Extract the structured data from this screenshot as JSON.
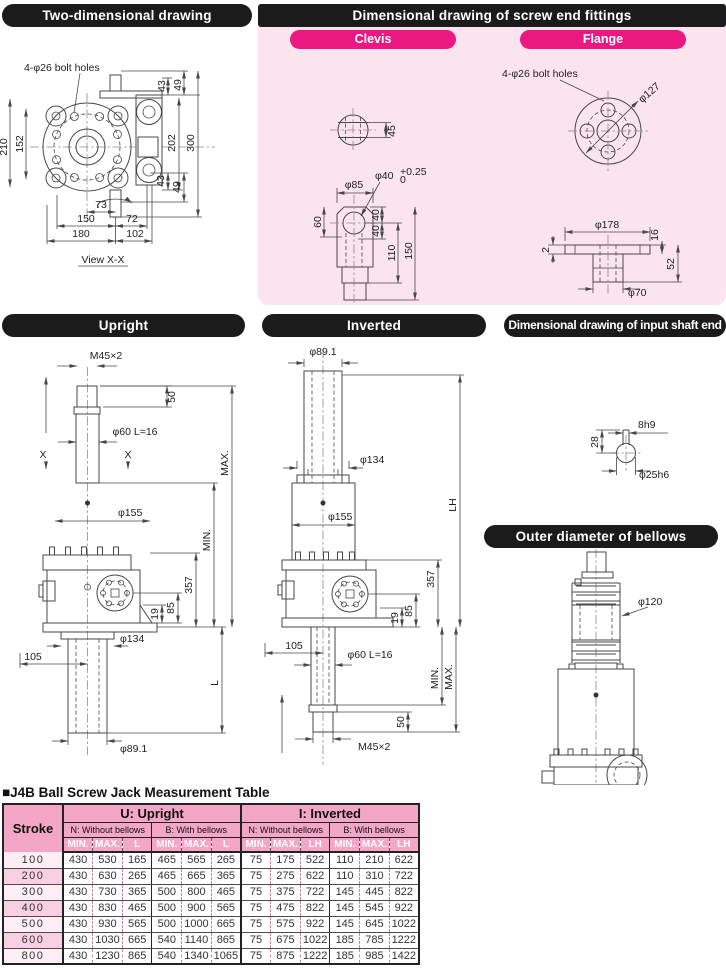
{
  "colors": {
    "header_bar": "#1b1b1b",
    "panel_pink": "#fce4ef",
    "accent_magenta": "#ec1882",
    "table_header_pink": "#f3a6c5",
    "row_stripe_pink": "#fde6f1",
    "line_color": "#474747"
  },
  "headers": {
    "two_dimensional": "Two-dimensional drawing",
    "screw_end": "Dimensional drawing of screw end fittings",
    "clevis": "Clevis",
    "flange": "Flange",
    "upright": "Upright",
    "inverted": "Inverted",
    "input_shaft": "Dimensional drawing of input shaft end",
    "bellows": "Outer diameter of bellows"
  },
  "two_dim": {
    "bolt_holes": "4-φ26 bolt holes",
    "d210": "210",
    "d152": "152",
    "d43_top": "43",
    "d49_top": "49",
    "d202": "202",
    "d300": "300",
    "d43_bot": "43",
    "d49_bot": "49",
    "d73": "73",
    "d150": "150",
    "d72": "72",
    "d180": "180",
    "d102": "102",
    "view_label": "View X-X"
  },
  "clevis_drawing": {
    "d45": "45",
    "d85": "φ85",
    "d40": "φ40",
    "d40_tol_top": "+0.25",
    "d40_tol_bot": "0",
    "d60": "60",
    "d40a": "40",
    "d40b": "40",
    "d110": "110",
    "d150": "150"
  },
  "flange_drawing": {
    "bolt_holes": "4-φ26 bolt holes",
    "d127": "φ127",
    "d178": "φ178",
    "d2": "2",
    "d16": "16",
    "d52": "52",
    "d70": "φ70"
  },
  "upright_drawing": {
    "m45": "M45×2",
    "d50": "50",
    "d60": "φ60 L=16",
    "x_left": "X",
    "x_right": "X",
    "max": "MAX.",
    "min": "MIN.",
    "d155": "φ155",
    "d357": "357",
    "d19": "19",
    "d85": "85",
    "d134": "φ134",
    "d105": "105",
    "L": "L",
    "d891": "φ89.1"
  },
  "inverted_drawing": {
    "d891": "φ89.1",
    "d134": "φ134",
    "lh": "LH",
    "d155": "φ155",
    "d357": "357",
    "d19": "19",
    "d85": "85",
    "d105": "105",
    "d60": "φ60 L=16",
    "min": "MIN.",
    "max": "MAX.",
    "d50": "50",
    "m45": "M45×2"
  },
  "input_shaft_drawing": {
    "d28": "28",
    "key": "8h9",
    "shaft": "φ25h6"
  },
  "bellows_drawing": {
    "d120": "φ120"
  },
  "table": {
    "title": "■J4B Ball Screw Jack Measurement Table",
    "stroke_header": "Stroke",
    "groups": [
      {
        "label": "U: Upright",
        "subs": [
          {
            "label": "N: Without bellows",
            "cols": [
              "MIN.",
              "MAX.",
              "L"
            ]
          },
          {
            "label": "B: With bellows",
            "cols": [
              "MIN.",
              "MAX.",
              "L"
            ]
          }
        ]
      },
      {
        "label": "I: Inverted",
        "subs": [
          {
            "label": "N: Without bellows",
            "cols": [
              "MIN.",
              "MAX.",
              "LH"
            ]
          },
          {
            "label": "B: With bellows",
            "cols": [
              "MIN.",
              "MAX.",
              "LH"
            ]
          }
        ]
      }
    ],
    "rows": [
      {
        "stroke": "100",
        "values": [
          "430",
          "530",
          "165",
          "465",
          "565",
          "265",
          "75",
          "175",
          "522",
          "110",
          "210",
          "622"
        ]
      },
      {
        "stroke": "200",
        "values": [
          "430",
          "630",
          "265",
          "465",
          "665",
          "365",
          "75",
          "275",
          "622",
          "110",
          "310",
          "722"
        ]
      },
      {
        "stroke": "300",
        "values": [
          "430",
          "730",
          "365",
          "500",
          "800",
          "465",
          "75",
          "375",
          "722",
          "145",
          "445",
          "822"
        ]
      },
      {
        "stroke": "400",
        "values": [
          "430",
          "830",
          "465",
          "500",
          "900",
          "565",
          "75",
          "475",
          "822",
          "145",
          "545",
          "922"
        ]
      },
      {
        "stroke": "500",
        "values": [
          "430",
          "930",
          "565",
          "500",
          "1000",
          "665",
          "75",
          "575",
          "922",
          "145",
          "645",
          "1022"
        ]
      },
      {
        "stroke": "600",
        "values": [
          "430",
          "1030",
          "665",
          "540",
          "1140",
          "865",
          "75",
          "675",
          "1022",
          "185",
          "785",
          "1222"
        ]
      },
      {
        "stroke": "800",
        "values": [
          "430",
          "1230",
          "865",
          "540",
          "1340",
          "1065",
          "75",
          "875",
          "1222",
          "185",
          "985",
          "1422"
        ]
      }
    ]
  }
}
